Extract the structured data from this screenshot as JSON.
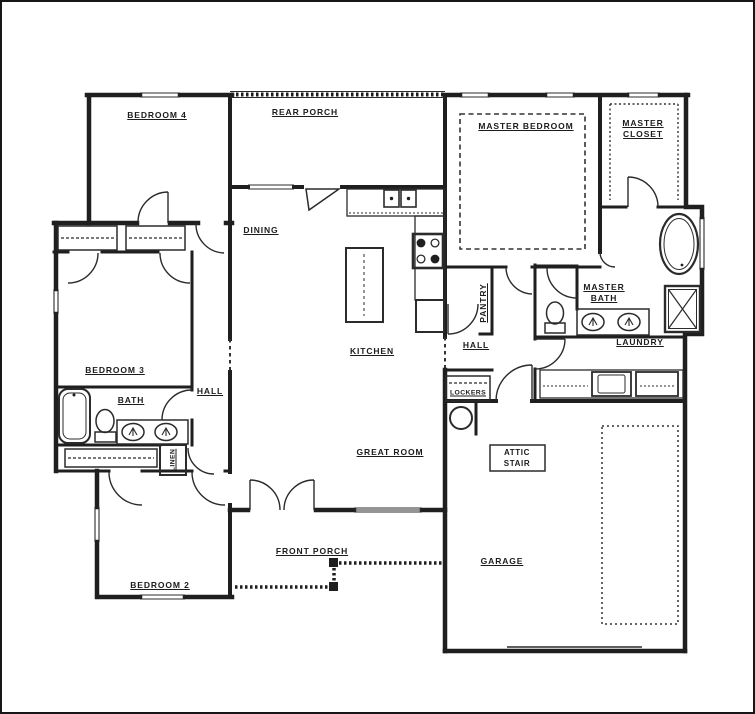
{
  "title": "House Floor Plan",
  "rooms": {
    "bedroom4": {
      "label": "BEDROOM 4"
    },
    "rear_porch": {
      "label": "REAR PORCH"
    },
    "master_bedroom": {
      "label": "MASTER BEDROOM"
    },
    "master_closet": {
      "line1": "MASTER",
      "line2": "CLOSET"
    },
    "dining": {
      "label": "DINING"
    },
    "kitchen": {
      "label": "KITCHEN"
    },
    "bedroom3": {
      "label": "BEDROOM 3"
    },
    "bath": {
      "label": "BATH"
    },
    "hall_left": {
      "label": "HALL"
    },
    "linen": {
      "label": "LINEN"
    },
    "pantry": {
      "label": "PANTRY"
    },
    "hall_right": {
      "label": "HALL"
    },
    "master_bath": {
      "line1": "MASTER",
      "line2": "BATH"
    },
    "laundry": {
      "label": "LAUNDRY"
    },
    "lockers": {
      "label": "LOCKERS"
    },
    "great_room": {
      "label": "GREAT ROOM"
    },
    "bedroom2": {
      "label": "BEDROOM 2"
    },
    "front_porch": {
      "label": "FRONT PORCH"
    },
    "attic_stair": {
      "line1": "ATTIC",
      "line2": "STAIR"
    },
    "garage": {
      "label": "GARAGE"
    }
  },
  "colors": {
    "wall": "#1f1f1f",
    "line": "#2b2b2b",
    "background": "#ffffff"
  }
}
